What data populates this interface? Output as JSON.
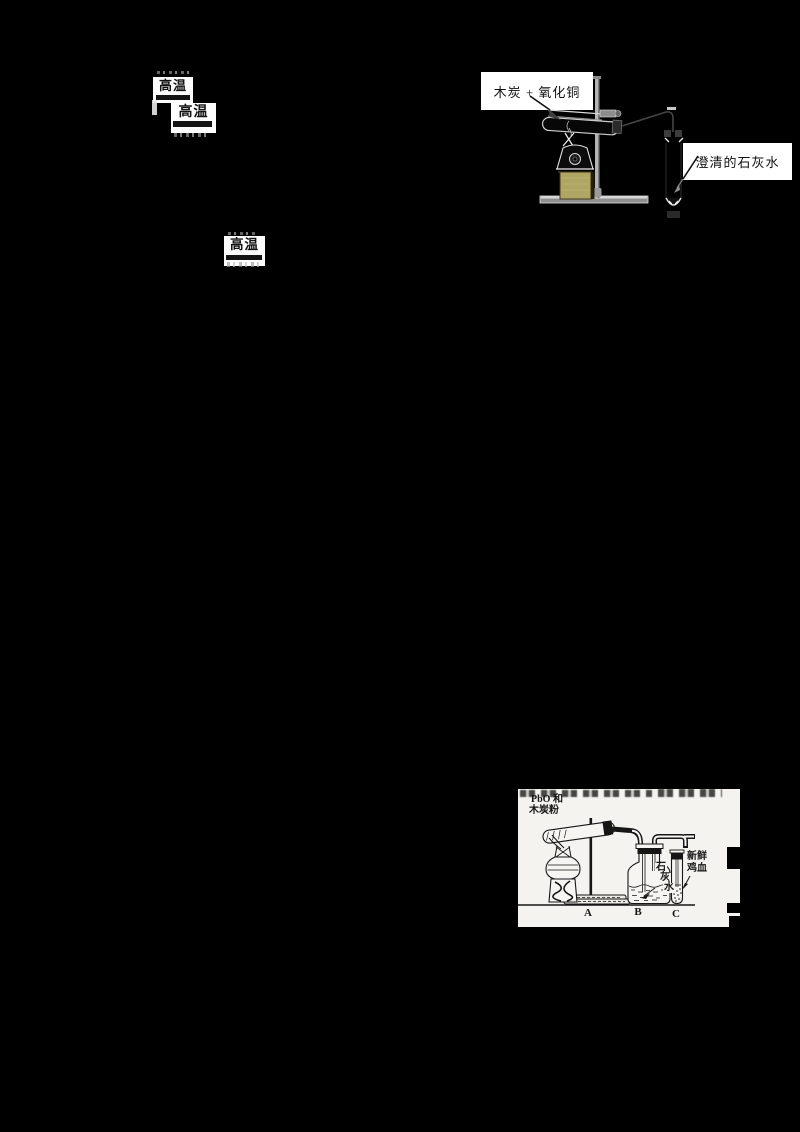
{
  "document": {
    "kind": "chemistry worksheet fragment on black background",
    "background_color": "#000000"
  },
  "equation_conditions": {
    "box1_label": "高温",
    "box2_label": "高温",
    "box3_label": "高温"
  },
  "experiment_charcoal_cuo": {
    "reagent_label": "木炭 + 氧化铜",
    "limewater_label": "澄清的石灰水",
    "lamp_base_color": "#b0a663"
  },
  "experiment_pbo": {
    "reagent_label_line1": "PbO 和",
    "reagent_label_line2": "木炭粉",
    "limewater_chars": [
      "石",
      "灰",
      "水"
    ],
    "blood_label_line1": "新鲜",
    "blood_label_line2": "鸡血",
    "apparatus_markers": [
      "A",
      "B",
      "C"
    ],
    "scan_background": "#f4f3ef"
  }
}
